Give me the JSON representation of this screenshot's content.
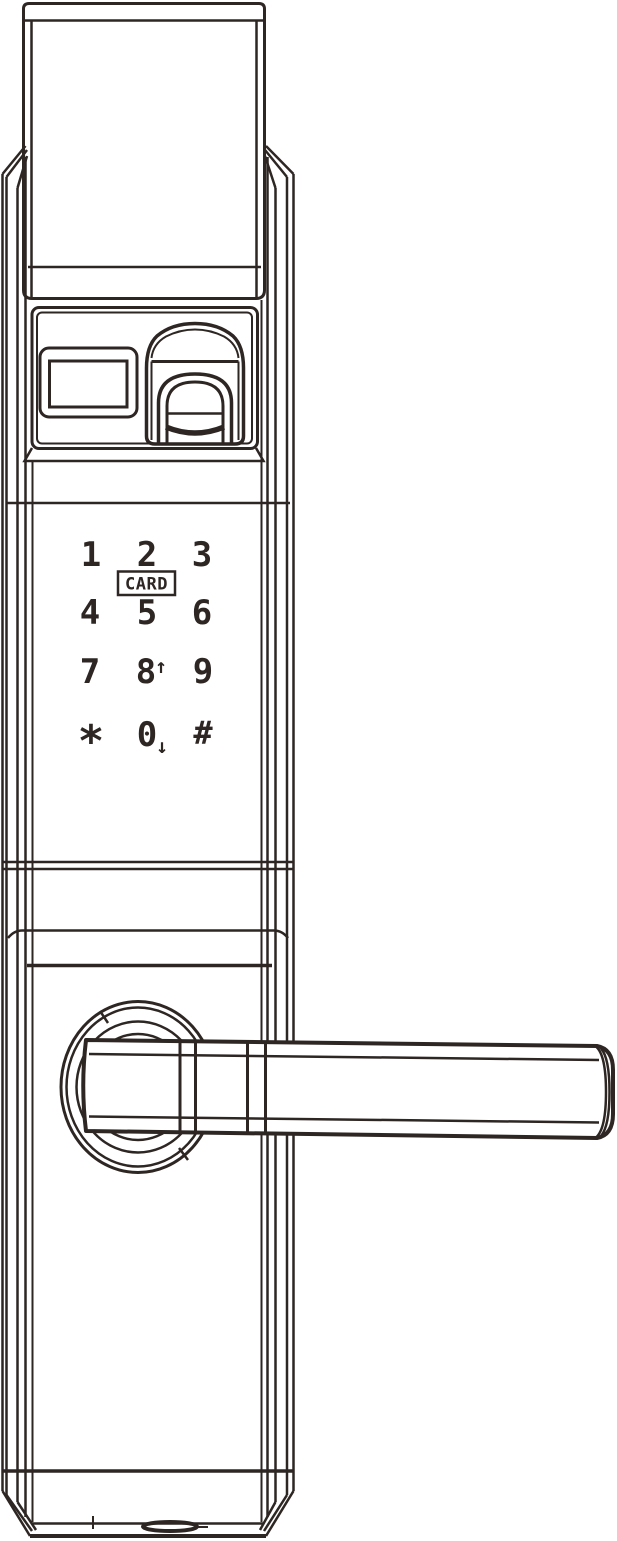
{
  "colors": {
    "line": "#2d2623",
    "background": "#ffffff"
  },
  "keypad": {
    "keys": [
      {
        "label": "1"
      },
      {
        "label": "2"
      },
      {
        "label": "3"
      },
      {
        "label": "4"
      },
      {
        "label": "5"
      },
      {
        "label": "6"
      },
      {
        "label": "7"
      },
      {
        "label": "8",
        "suffix": "↑"
      },
      {
        "label": "9"
      },
      {
        "label": "*"
      },
      {
        "label": "0",
        "suffix": "↓"
      },
      {
        "label": "#"
      }
    ],
    "card_label": "CARD"
  },
  "lock_parts": [
    "top-spindle-plate",
    "sensor-panel",
    "display-window",
    "fingerprint-reader",
    "keypad",
    "card-reader-badge",
    "handle-rose",
    "lever-handle",
    "bottom-port"
  ]
}
